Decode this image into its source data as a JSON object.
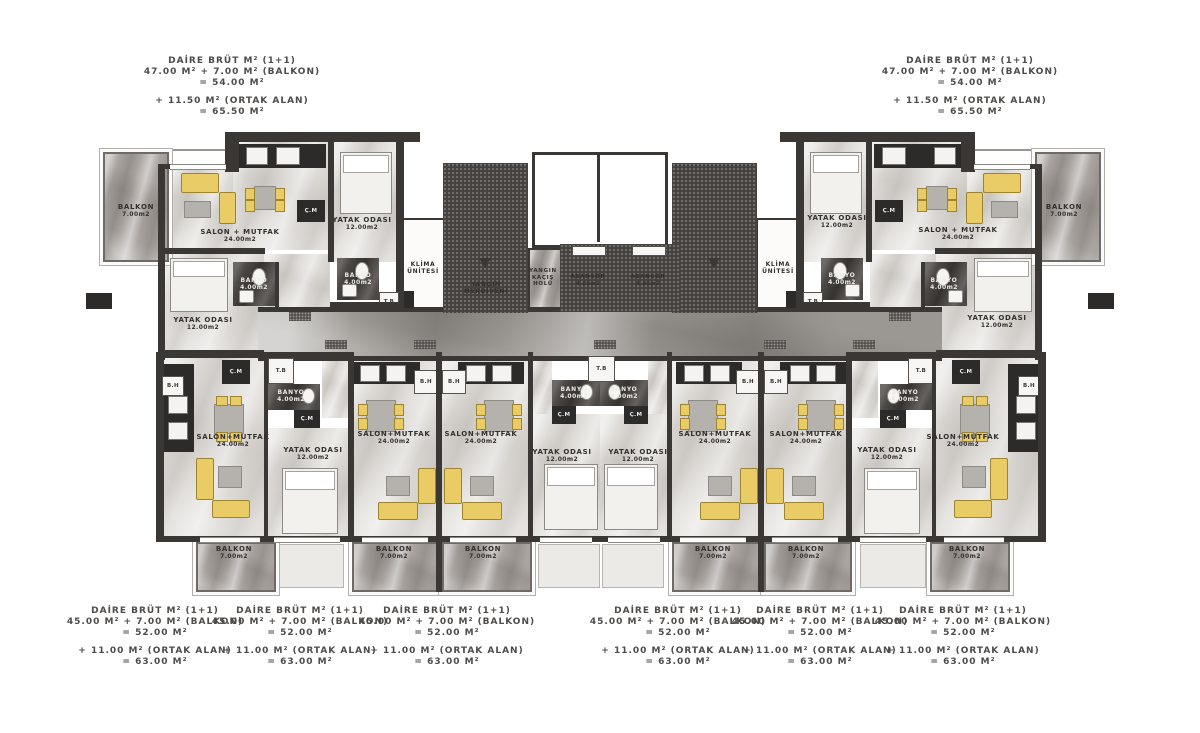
{
  "colors": {
    "wall_dark": "#3a3734",
    "tile_dark": "#4c4845",
    "corridor_marble": "#9b9792",
    "room_marble": "#dedbd7",
    "balcony_marble": "#aaa5a0",
    "furniture_yellow": "#e9cc66"
  },
  "labels": {
    "daire_title": "DAİRE BRÜT M² (1+1)",
    "top_sum": "47.00 M² + 7.00 M² (BALKON)",
    "top_total": "= 54.00 M²",
    "top_common": "+ 11.50 M² (ORTAK ALAN)",
    "top_grand": "= 65.50 M²",
    "bottom_sum": "45.00 M² + 7.00 M² (BALKON)",
    "bottom_total": "= 52.00 M²",
    "bottom_common": "+ 11.00 M² (ORTAK ALAN)",
    "bottom_grand": "= 63.00 M²",
    "salon": "SALON+MUTFAK",
    "salon_spaced": "SALON + MUTFAK",
    "area_salon": "24.00m2",
    "bedroom": "YATAK ODASI",
    "area_bedroom": "12.00m2",
    "banyo": "BANYO",
    "area_banyo": "4.00m2",
    "balkon": "BALKON",
    "area_balkon": "7.00m2",
    "klima_1": "KLİMA",
    "klima_2": "ÜNİTESİ",
    "yangin_1": "YANGIN",
    "yangin_2": "MERDİVENİ",
    "kacis_1": "YANGIN",
    "kacis_2": "KAÇIŞ",
    "kacis_3": "HOLÜ",
    "asansor": "ASANSÖR",
    "area_asansor": "4.00m2",
    "cm": "Ç.M",
    "tb": "T.B",
    "bh": "B.H"
  }
}
